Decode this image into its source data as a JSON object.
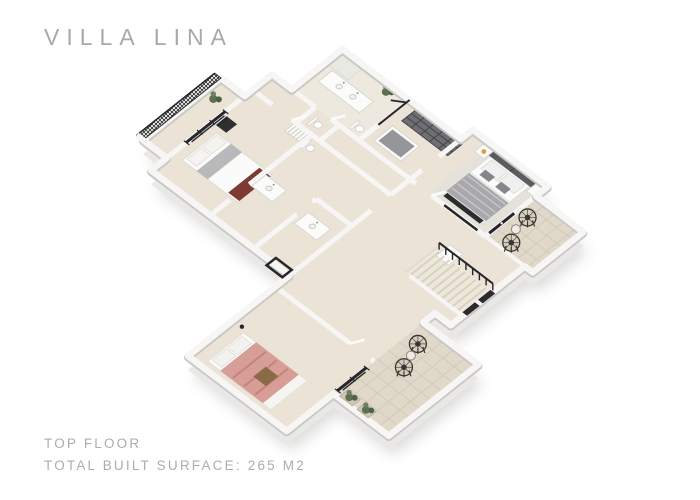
{
  "header": {
    "title": "VILLA LINA"
  },
  "footer": {
    "floor_label": "TOP FLOOR",
    "surface_label": "TOTAL BUILT SURFACE: 265 M2"
  },
  "floor_plan": {
    "type": "isometric-3d-render",
    "rooms": [
      "balcony",
      "left-bedroom",
      "ensuite-bathroom",
      "second-bathroom",
      "wc",
      "hallway",
      "main-bathroom",
      "walk-in-closet",
      "master-bedroom",
      "master-terrace",
      "staircase-hall",
      "lower-bedroom",
      "lower-terrace"
    ],
    "furniture": [
      "left-bed-with-gray-runner",
      "desk-chair",
      "single-vanity",
      "double-vanity",
      "toilets",
      "closet-shelving",
      "closet-island",
      "master-bed-gray-bedding",
      "nightstands-with-lamp",
      "pink-bed",
      "wicker-chairs",
      "side-tables",
      "planter-boxes",
      "plants",
      "staircase-with-black-railing",
      "black-framed-sliding-doors",
      "balcony-mesh-railing"
    ]
  },
  "palette": {
    "background": "#ffffff",
    "title_text": "#a9a9a9",
    "footer_text": "#adadad",
    "wall_white": "#f7f6f4",
    "wall_edge": "#c9c8c5",
    "wall_face": "#e9e8e6",
    "wall_face_light": "#f3f2f0",
    "shadow": "#8f8e8b",
    "floor_beige": "#eae3d6",
    "floor_bath": "#eee9df",
    "floor_stairs": "#eee8db",
    "tile_beige": "#e0d8c9",
    "tile_line": "#d2cabb",
    "accent_black": "#26262a",
    "furniture_dark": "#6f6f73",
    "furniture_darker": "#46464a",
    "bed_white": "#fbfbfa",
    "bedding_gray": "#a8a8ac",
    "bed_pink": "#d79e97",
    "pink_stripe": "#c4837c",
    "bed_maroon": "#7d3a33",
    "wood_brown": "#8a6b48",
    "plant_green": "#5d7052",
    "plant_green_dark": "#4e6143",
    "lamp_orange": "#e09a3f",
    "rug_gray": "#e3e1de",
    "runner_gray": "#b9b9bc"
  }
}
